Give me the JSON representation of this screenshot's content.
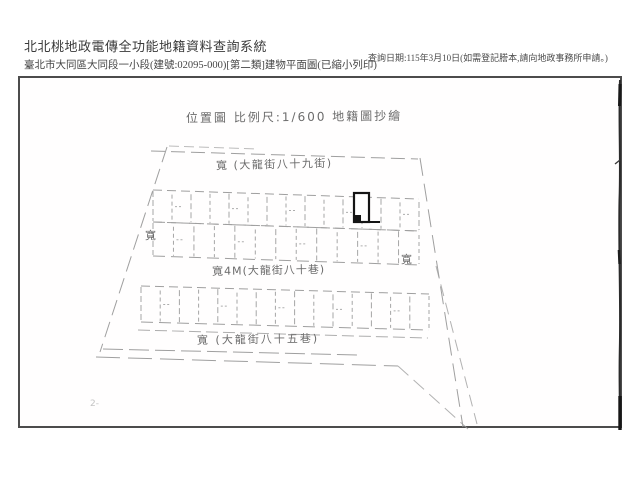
{
  "header": {
    "system_title": "北北桃地政電傳全功能地籍資料查詢系統",
    "document_title": "臺北市大同區大同段一小段(建號:02095-000)[第二類]建物平面圖(已縮小列印)",
    "query_date_note": "查詢日期:115年3月10日(如需登記謄本,請向地政事務所申請。)"
  },
  "plan": {
    "title_annotation": "位置圖 比例尺:1/600 地籍圖抄繪",
    "labels": {
      "top_street": "寬 (大龍街八十九街)",
      "middle_lane": "寬4M(大龍街八十巷)",
      "bottom_lane": "寬 (大龍街八十五巷)",
      "left_width": "寬",
      "right_width": "寬",
      "corner_note": "2-"
    },
    "geometry": {
      "blocks": [
        {
          "lx": 153,
          "ly": 190,
          "rx": 419,
          "ry": 199,
          "h": 32,
          "units": 14
        },
        {
          "lx": 153,
          "ly": 222,
          "rx": 419,
          "ry": 231,
          "h": 34,
          "units": 13
        },
        {
          "lx": 141,
          "ly": 286,
          "rx": 429,
          "ry": 294,
          "h": 36,
          "units": 15
        }
      ]
    }
  },
  "colors": {
    "sketch_line": "#9f9f9f",
    "subject_building": "#141414",
    "scan_artifact": "#2b2b2b",
    "frame_border": "#4c4c4c"
  }
}
